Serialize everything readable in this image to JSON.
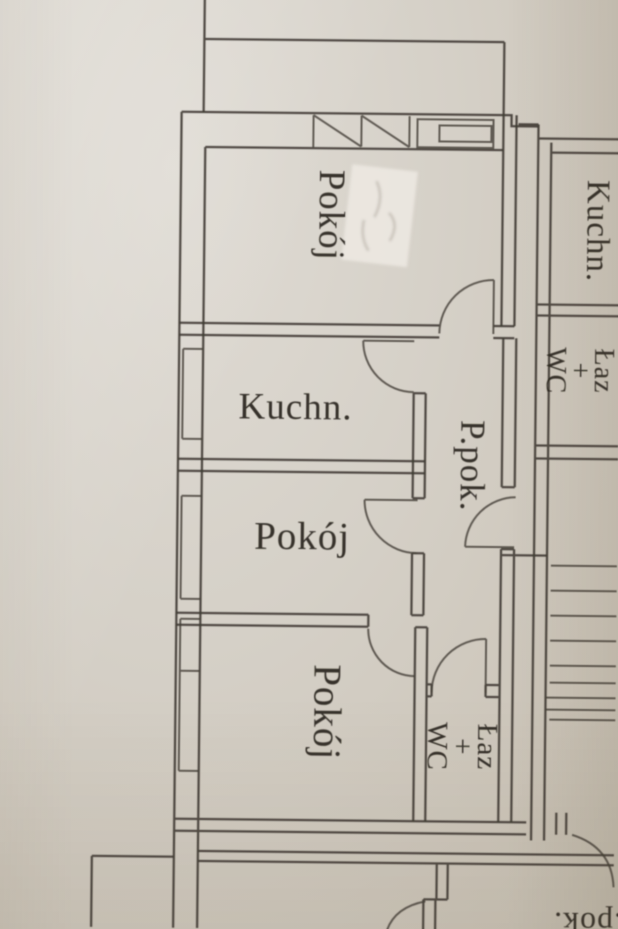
{
  "page": {
    "kind": "scanned floor plan photo",
    "paper_color": "#d5d0c7",
    "line_color": "#3f3a32",
    "text_color": "#29241d"
  },
  "labels": {
    "left_apartment": {
      "room_top": "Pokój",
      "kitchen": "Kuchn.",
      "room_middle": "Pokój",
      "room_bottom": "Pokój",
      "hall": "P.pok.",
      "bath_line1": "Łaz",
      "bath_line2": "+",
      "bath_line3": "WC"
    },
    "right_apartment": {
      "kitchen": "Kuchn.",
      "bath_line1": "Łaz",
      "bath_line2": "+",
      "bath_line3": "WC"
    },
    "lower_apartment": {
      "hall": "P.pok."
    }
  }
}
